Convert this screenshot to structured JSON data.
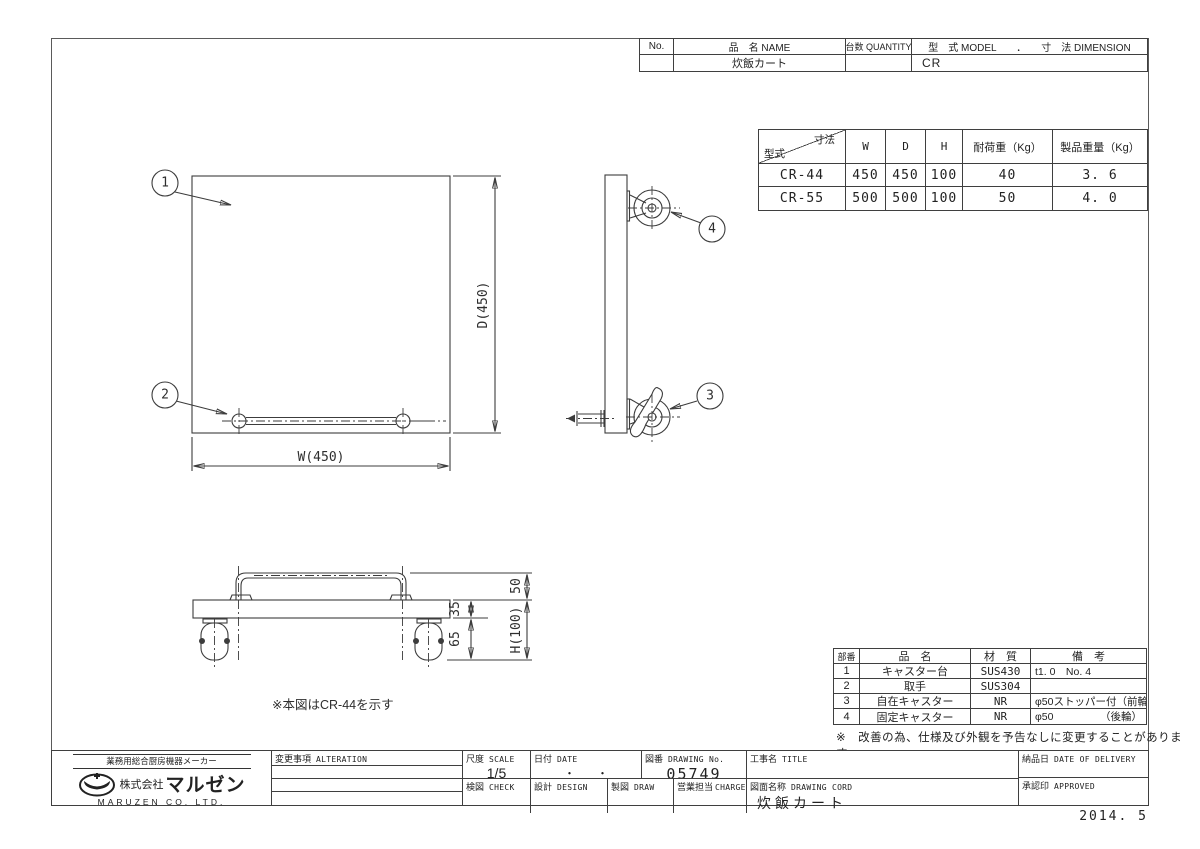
{
  "header_table": {
    "no_label": "No.",
    "name_label": "品　名 NAME",
    "qty_label": "台数 QUANTITY",
    "model_label": "型　式 MODEL　　．　　寸　法 DIMENSION",
    "name_value": "炊飯カート",
    "model_value": "CR"
  },
  "spec_table": {
    "diag_top_label": "寸法",
    "diag_bottom_label": "型式",
    "col_w": "W",
    "col_d": "D",
    "col_h": "H",
    "col_load": "耐荷重（Kg）",
    "col_weight": "製品重量（Kg）",
    "rows": [
      {
        "model": "CR-44",
        "w": "450",
        "d": "450",
        "h": "100",
        "load": "40",
        "weight": "3. 6"
      },
      {
        "model": "CR-55",
        "w": "500",
        "d": "500",
        "h": "100",
        "load": "50",
        "weight": "4. 0"
      }
    ]
  },
  "drawing": {
    "balloon_1": "1",
    "balloon_2": "2",
    "balloon_3": "3",
    "balloon_4": "4",
    "dim_d": "D(450)",
    "dim_w": "W(450)",
    "dim_handle_height": "50",
    "dim_plate_thickness": "35",
    "dim_caster_height": "65",
    "dim_total_height": "H(100)",
    "note": "※本図はCR-44を示す"
  },
  "parts_table": {
    "col_no": "部番",
    "col_name": "品　名",
    "col_material": "材　質",
    "col_remark": "備　考",
    "rows": [
      {
        "no": "1",
        "name": "キャスター台",
        "material": "SUS430",
        "remark": "t1. 0　No. 4",
        "remark_right": ""
      },
      {
        "no": "2",
        "name": "取手",
        "material": "SUS304",
        "remark": "",
        "remark_right": ""
      },
      {
        "no": "3",
        "name": "自在キャスター",
        "material": "NR",
        "remark": "φ50ストッパー付（前輪）",
        "remark_right": ""
      },
      {
        "no": "4",
        "name": "固定キャスター",
        "material": "NR",
        "remark": "φ50",
        "remark_right": "（後輪）"
      }
    ],
    "footnote": "※　改善の為、仕様及び外観を予告なしに変更することがあります。"
  },
  "title_block": {
    "company_tagline": "業務用総合厨房機器メーカー",
    "company_prefix": "株式会社",
    "company_name": "マルゼン",
    "company_en": "MARUZEN  CO. LTD.",
    "alteration_jp": "変更事項",
    "alteration_en": "ALTERATION",
    "scale_jp": "尺度",
    "scale_en": "SCALE",
    "scale_value": "1/5",
    "date_jp": "日付",
    "date_en": "DATE",
    "date_value": "・　　・",
    "drawing_no_jp": "図番",
    "drawing_no_en": "DRAWING No.",
    "drawing_no_value": "05749",
    "title_jp": "工事名",
    "title_en": "TITLE",
    "check_jp": "検図",
    "check_en": "CHECK",
    "design_jp": "設計",
    "design_en": "DESIGN",
    "draw_jp": "製図",
    "draw_en": "DRAW",
    "charge_jp": "営業担当",
    "charge_en": "CHARGE",
    "drawing_name_jp": "図面名称",
    "drawing_name_en": "DRAWING CORD",
    "drawing_name_value": "炊飯カート",
    "delivery_jp": "納品日",
    "delivery_en": "DATE OF DELIVERY",
    "approved_jp": "承認印",
    "approved_en": "APPROVED",
    "date_stamp": "2014. 5"
  }
}
